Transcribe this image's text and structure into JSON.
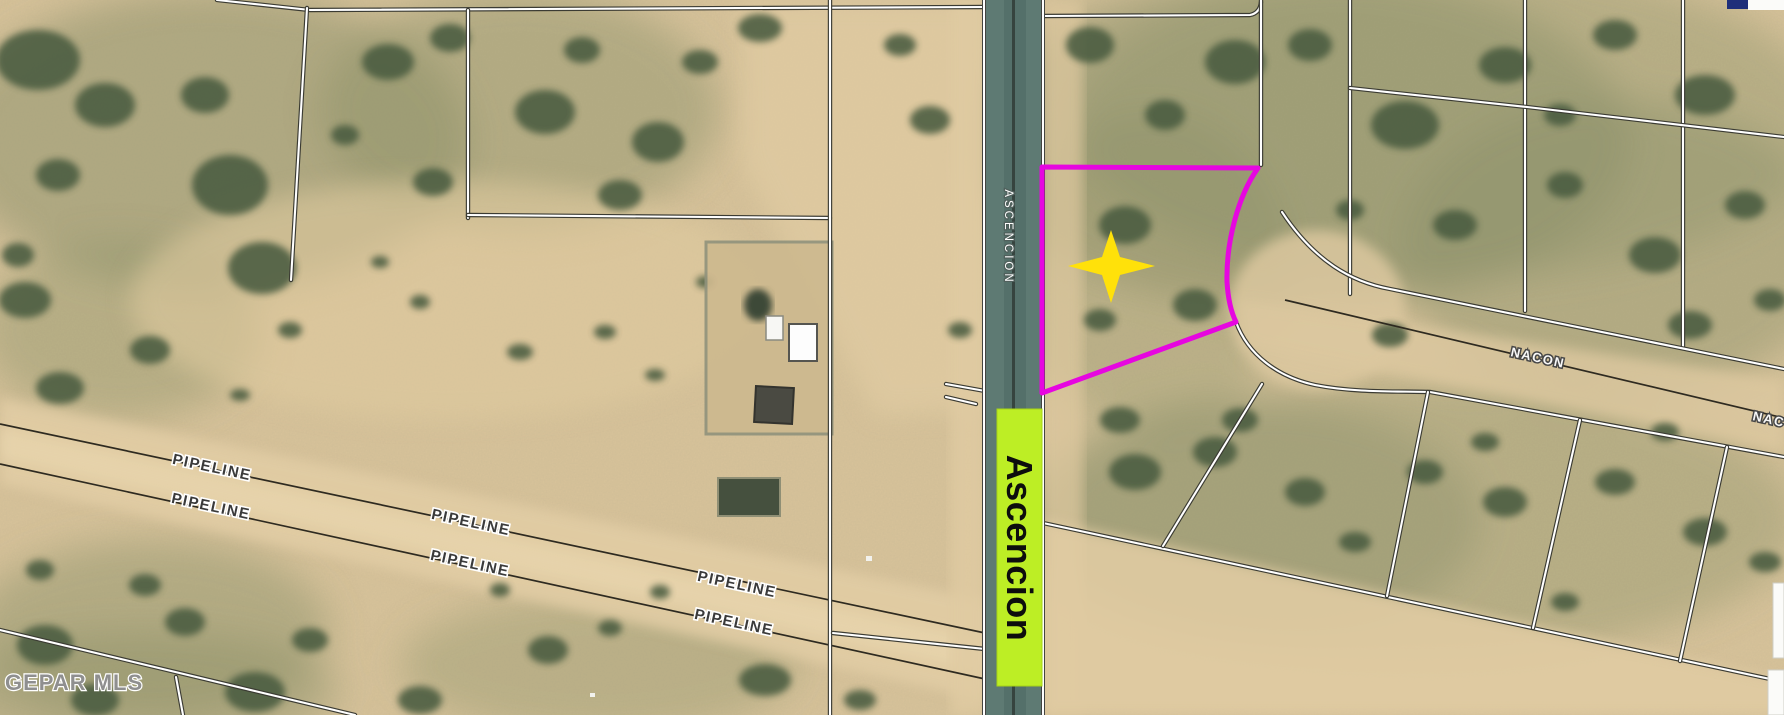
{
  "map": {
    "title_watermark": "GEPAR MLS",
    "roads": {
      "ascencion_sign_label": "Ascencion",
      "ascencion_street_label": "ASCENCION",
      "nacon_label_1": "NACON",
      "nacon_label_2": "NACON"
    },
    "pipeline_label": "PIPELINE",
    "marker": {
      "shape": "four-point-star",
      "color": "#ffe10a"
    },
    "highlight": {
      "sign_color": "#bdee25",
      "parcel_outline_color": "#e606e0"
    },
    "colors": {
      "terrain_tan": "#d8c39a",
      "dirt_road": "#e2cda5",
      "vegetation": "#4a5c41",
      "road_pavement": "#5e7a73",
      "parcel_line": "#ffffff"
    }
  }
}
